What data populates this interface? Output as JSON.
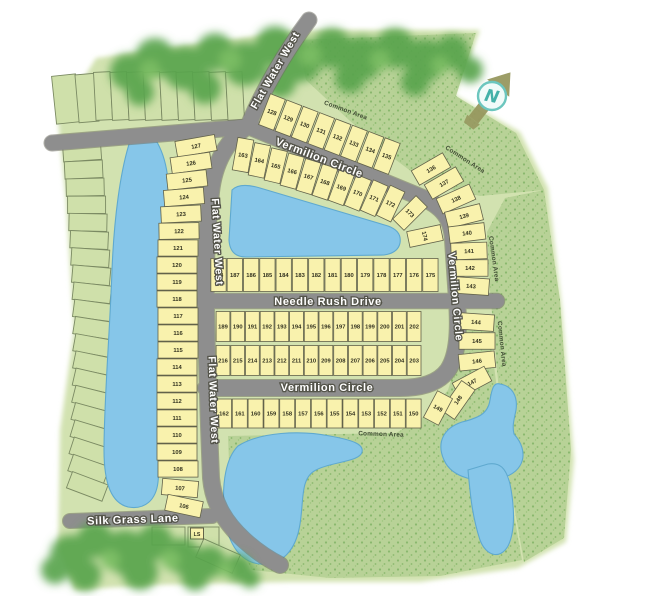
{
  "map": {
    "compass_label": "N",
    "lift_station_label": "LS",
    "common_area_label": "Common Area",
    "streets": {
      "flat_water_west": "Flat Water West",
      "vermilion_circle": "Vermilion Circle",
      "needle_rush_drive": "Needle Rush Drive",
      "silk_grass_lane": "Silk Grass Lane"
    },
    "colors": {
      "land": "#d2e2b0",
      "water": "#86c6e9",
      "street": "#8e8e8e",
      "lot_fill": "#f9f2ad",
      "trees": "#5aa44d",
      "common_area_texture": "#8ab86d",
      "compass_teal": "#4fb5ac",
      "compass_olive": "#97985f"
    },
    "lots": {
      "west_column": [
        127,
        126,
        125,
        124,
        123,
        122,
        121,
        120,
        119,
        118,
        117,
        116,
        115,
        114,
        113,
        112,
        111,
        110,
        109,
        108,
        107,
        106
      ],
      "north_row": [
        128,
        129,
        130,
        131,
        132,
        133,
        134,
        135
      ],
      "inner_upper_row": [
        163,
        164,
        165,
        166,
        167,
        168,
        169,
        170,
        171,
        172
      ],
      "upper_arc": [
        173,
        174
      ],
      "east_arc": [
        136,
        137,
        138,
        139,
        140,
        141,
        142,
        143
      ],
      "southeast_arc": [
        144,
        145,
        146,
        147,
        148
      ],
      "needle_rush_north": [
        188,
        187,
        186,
        185,
        184,
        183,
        182,
        181,
        180,
        179,
        178,
        177,
        176,
        175
      ],
      "needle_rush_south": [
        189,
        190,
        191,
        192,
        193,
        194,
        195,
        196,
        197,
        198,
        199,
        200,
        201,
        202
      ],
      "vermilion_north": [
        216,
        215,
        214,
        213,
        212,
        211,
        210,
        209,
        208,
        207,
        206,
        205,
        204,
        203
      ],
      "vermilion_south": [
        162,
        161,
        160,
        159,
        158,
        157,
        156,
        155,
        154,
        153,
        152,
        151,
        150,
        149
      ]
    }
  }
}
